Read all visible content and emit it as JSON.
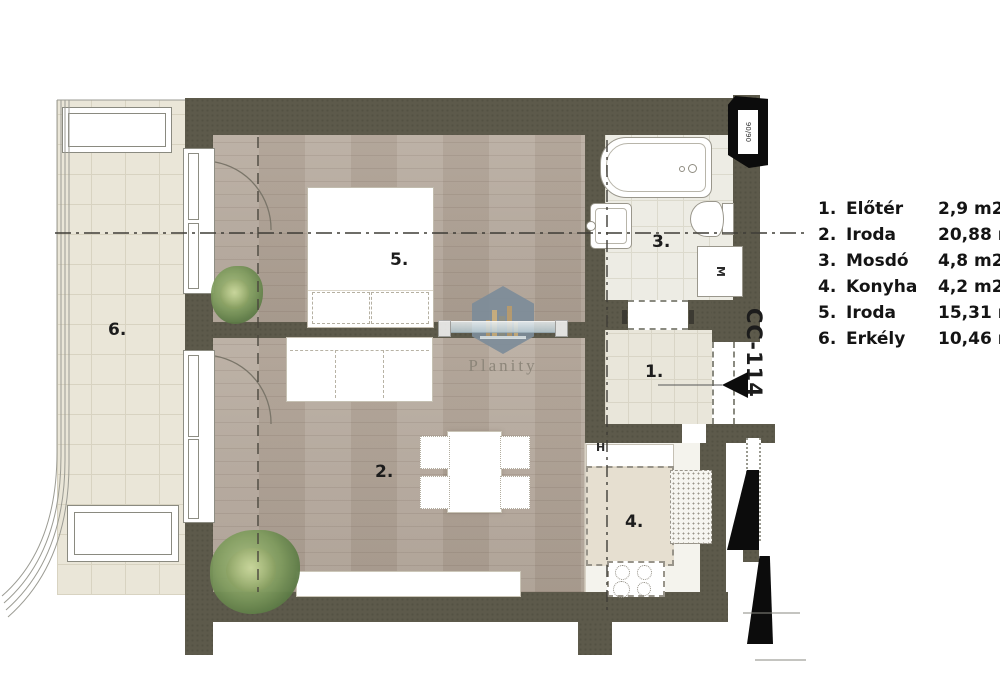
{
  "plan": {
    "unit_code": "CC-114",
    "room_labels": {
      "r1": "1.",
      "r2": "2.",
      "r3": "3.",
      "r4": "4.",
      "r5": "5.",
      "r6": "6."
    },
    "markers": {
      "hydrant": "H",
      "washing_machine": "M",
      "radiator_size": "90/90"
    }
  },
  "legend": {
    "items": [
      {
        "no": "1.",
        "name": "Előtér",
        "area": "2,9 m2"
      },
      {
        "no": "2.",
        "name": "Iroda",
        "area": "20,88 m2"
      },
      {
        "no": "3.",
        "name": "Mosdó",
        "area": "4,8 m2"
      },
      {
        "no": "4.",
        "name": "Konyha",
        "area": "4,2 m2"
      },
      {
        "no": "5.",
        "name": "Iroda",
        "area": "15,31 m2"
      },
      {
        "no": "6.",
        "name": "Erkély",
        "area": "10,46 m2"
      }
    ]
  },
  "watermark": {
    "brand": "Planity"
  },
  "colors": {
    "wall": "#5d5a4b",
    "wood_floor": "#b4a79a",
    "balcony_tile": "#eae6d8",
    "marker_black": "#0c0c0c",
    "logo_hex": "#7d8c99"
  }
}
